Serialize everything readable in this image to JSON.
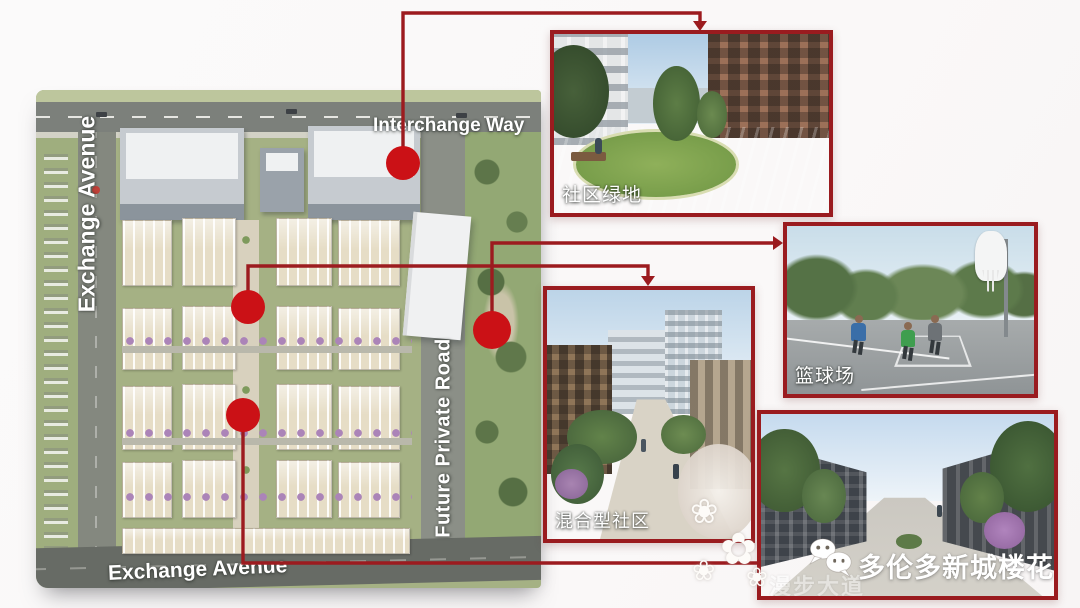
{
  "map": {
    "streets": {
      "left": "Exchange Avenue",
      "top": "Interchange Way",
      "right": "Future Private Road",
      "bottom": "Exchange Avenue"
    }
  },
  "insets": {
    "green_space": {
      "label": "社区绿地"
    },
    "basketball": {
      "label": "篮球场"
    },
    "mixed_community": {
      "label": "混合型社区"
    }
  },
  "watermark": {
    "brand": "多伦多新城楼花",
    "faint_street": "漫步大道"
  },
  "colors": {
    "line": "#9c1b1f",
    "dot": "#cb1116",
    "inset_border": "#9a1b1f"
  }
}
